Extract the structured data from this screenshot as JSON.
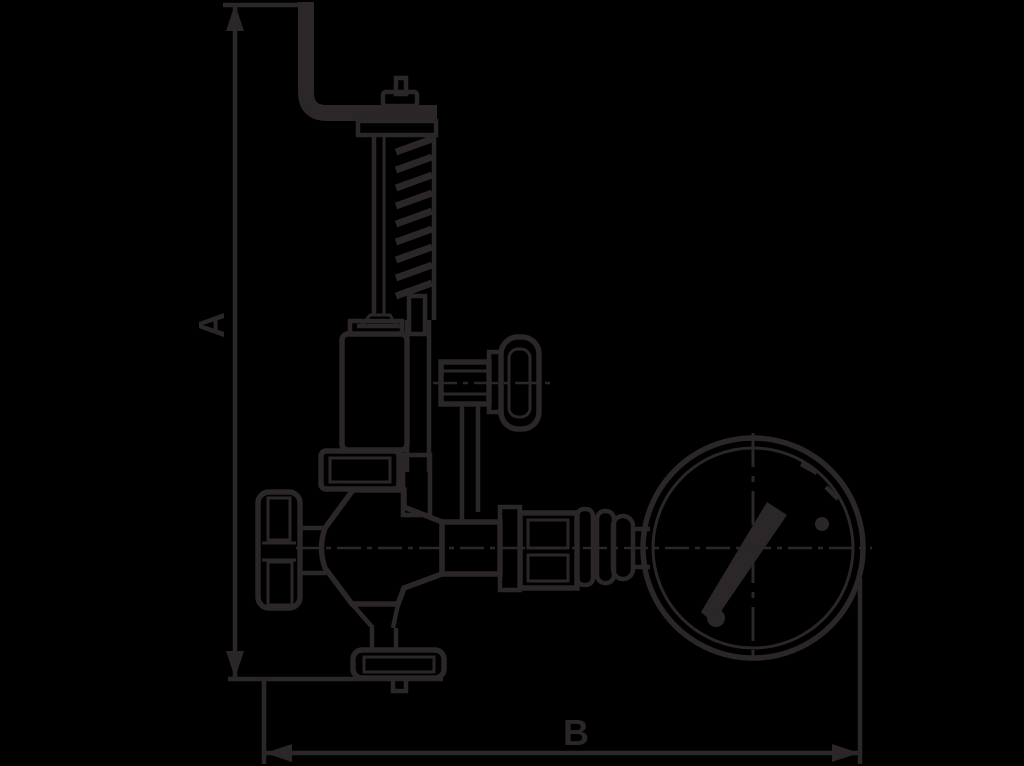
{
  "page": {
    "background_color": "#000000",
    "line_color": "#2b2627"
  },
  "drawing": {
    "type": "technical dimensional line drawing",
    "subject": "safety valve assembly with test lever, spring bonnet, shut-off handwheel, gauge valve and pressure gauge",
    "components": [
      "test-lever",
      "spindle-cap",
      "spring-bonnet",
      "spring-coils",
      "gauge-valve-knob",
      "gland-flange",
      "handwheel",
      "valve-body",
      "bottom-flange",
      "gauge-line",
      "pressure-gauge",
      "gauge-needle"
    ]
  },
  "dimensions": {
    "vertical": {
      "label": "A"
    },
    "horizontal": {
      "label": "B"
    }
  }
}
